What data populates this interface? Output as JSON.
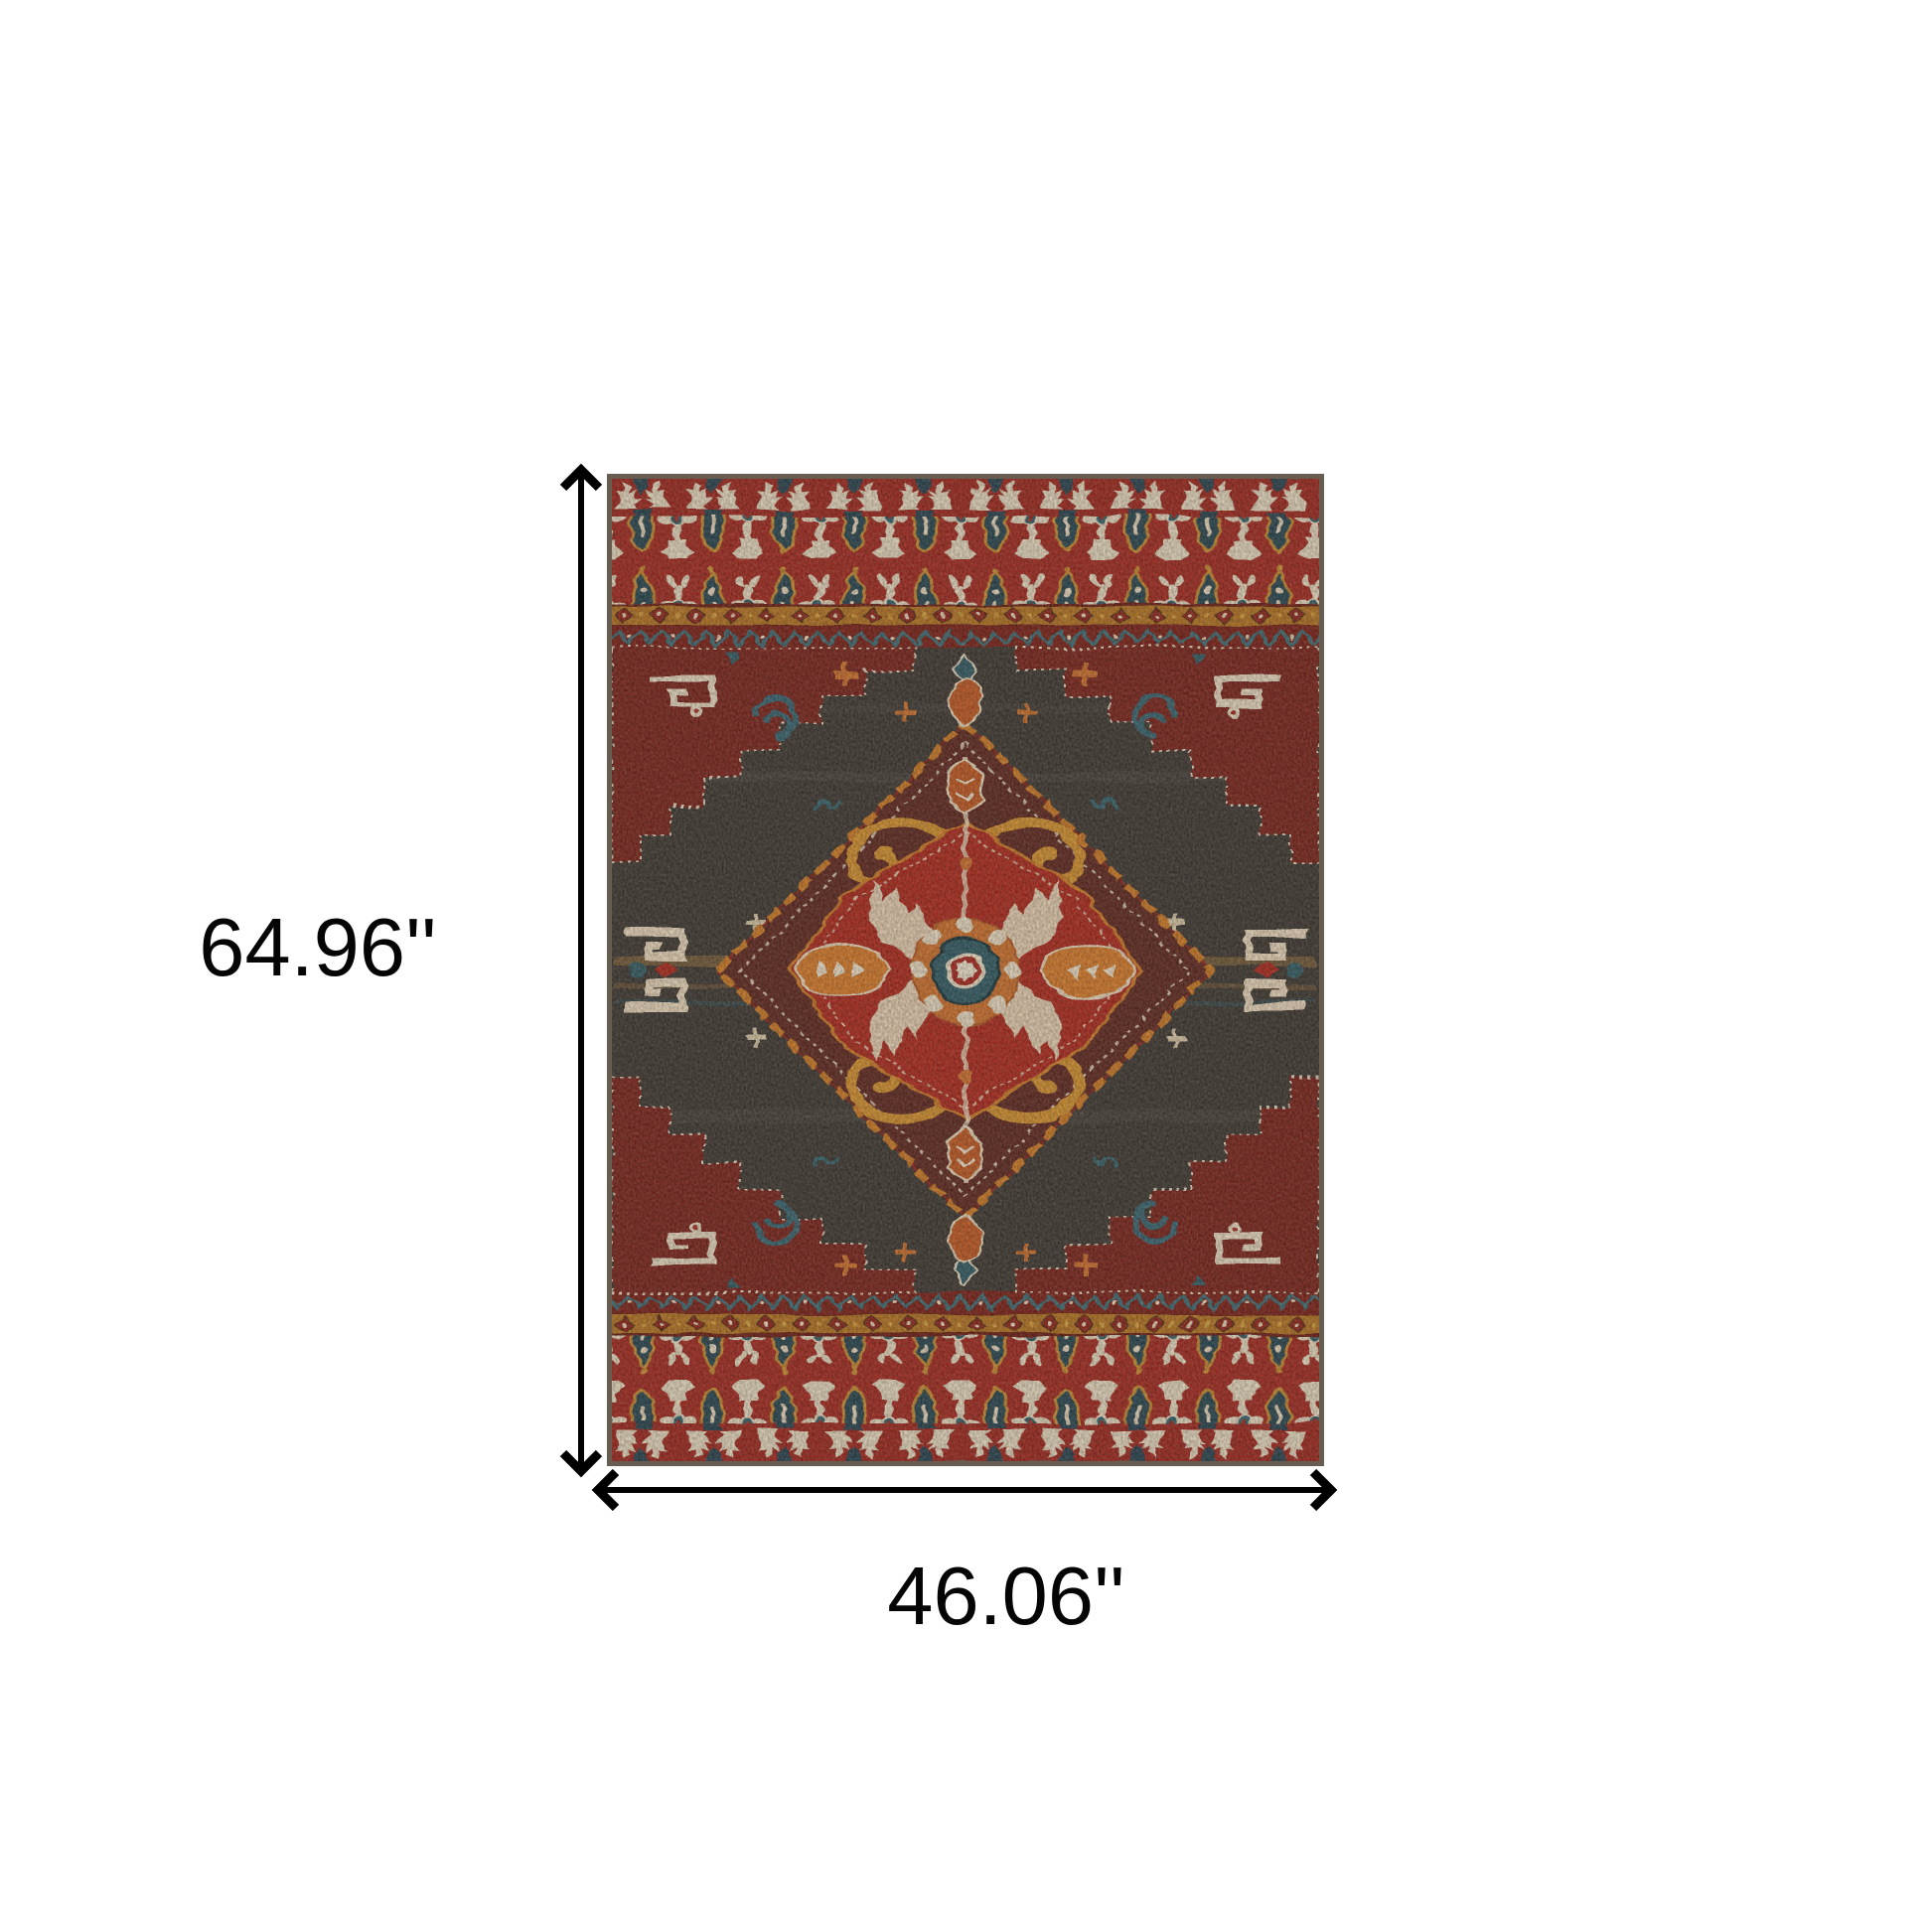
{
  "diagram": {
    "height_label": "64.96''",
    "width_label": "46.06''",
    "arrow_color": "#000000",
    "text_color": "#050505",
    "background": "#ffffff",
    "rug": {
      "description": "red charcoal and teal oriental heriz-style medallion area rug",
      "palette": {
        "binding": "#675d50",
        "skirt_red": "#a3251c",
        "deep_red": "#7c1f17",
        "bright_red": "#ae2519",
        "orange": "#d0702a",
        "gold": "#b5731f",
        "teal": "#2e5a64",
        "navy": "#24404e",
        "cream": "#e9dcc3",
        "field_charcoal": "#3b3530"
      }
    }
  }
}
